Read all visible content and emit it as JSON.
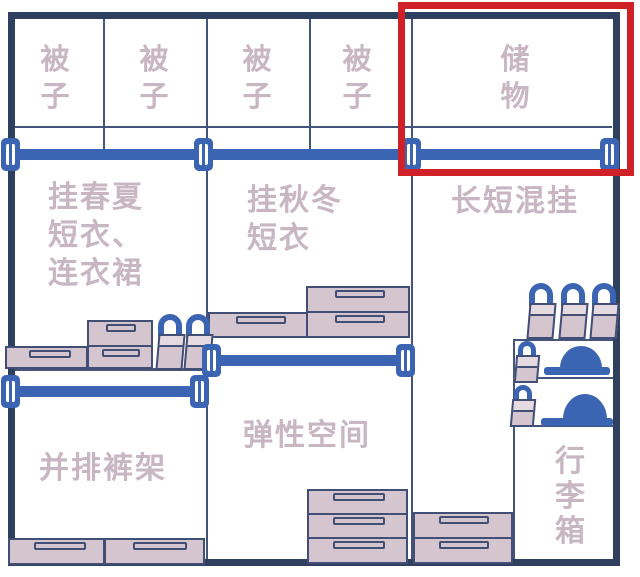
{
  "colors": {
    "frame": "#2e3f60",
    "line": "#45547c",
    "rod": "#3b64b2",
    "box_fill": "#d5c5ce",
    "box_border": "#414f76",
    "box_top": "#e4dadf",
    "text": "#c9b6c3",
    "highlight": "#cf2127",
    "background": "#ffffff"
  },
  "labels": {
    "quilt": [
      "被",
      "子"
    ],
    "storage": [
      "储",
      "物"
    ],
    "spring_summer": [
      "挂春夏",
      "短衣、",
      "连衣裙"
    ],
    "autumn_winter": [
      "挂秋冬",
      "短衣"
    ],
    "mixed_hang": "长短混挂",
    "flexible_space": "弹性空间",
    "pants_rack": "并排裤架",
    "luggage": [
      "行",
      "李",
      "箱"
    ]
  }
}
